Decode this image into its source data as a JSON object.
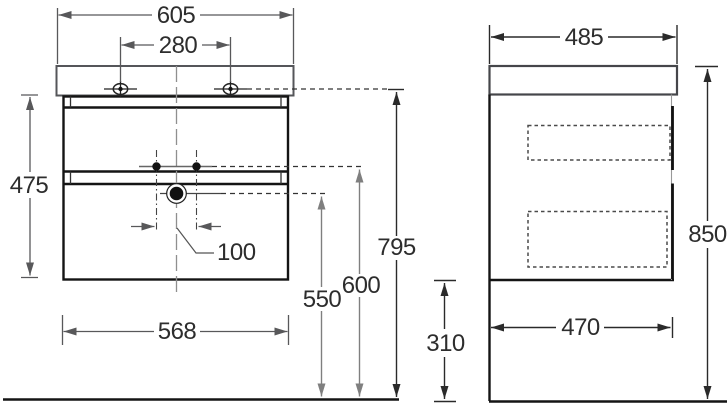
{
  "drawing": {
    "type": "technical-dimension-drawing",
    "subject": "wall-hung washbasin vanity cabinet, front and side views",
    "units": "mm",
    "front_view": {
      "top_width": "605",
      "faucet_hole_spacing": "280",
      "cabinet_height": "475",
      "fixing_hole_spacing": "100",
      "cabinet_width": "568",
      "drain_height": "550",
      "fixing_height": "600",
      "worktop_height": "795"
    },
    "side_view": {
      "top_depth": "485",
      "overall_height": "850",
      "cabinet_depth": "470",
      "floor_clearance": "310"
    },
    "colors": {
      "background": "#ffffff",
      "outline": "#141414",
      "worktop_outline": "#55565a",
      "dim_gray": "#58585a",
      "dim_light": "#7f7f7f",
      "dim_dark": "#2a2a2a",
      "label_text": "#2d2d2d"
    }
  }
}
